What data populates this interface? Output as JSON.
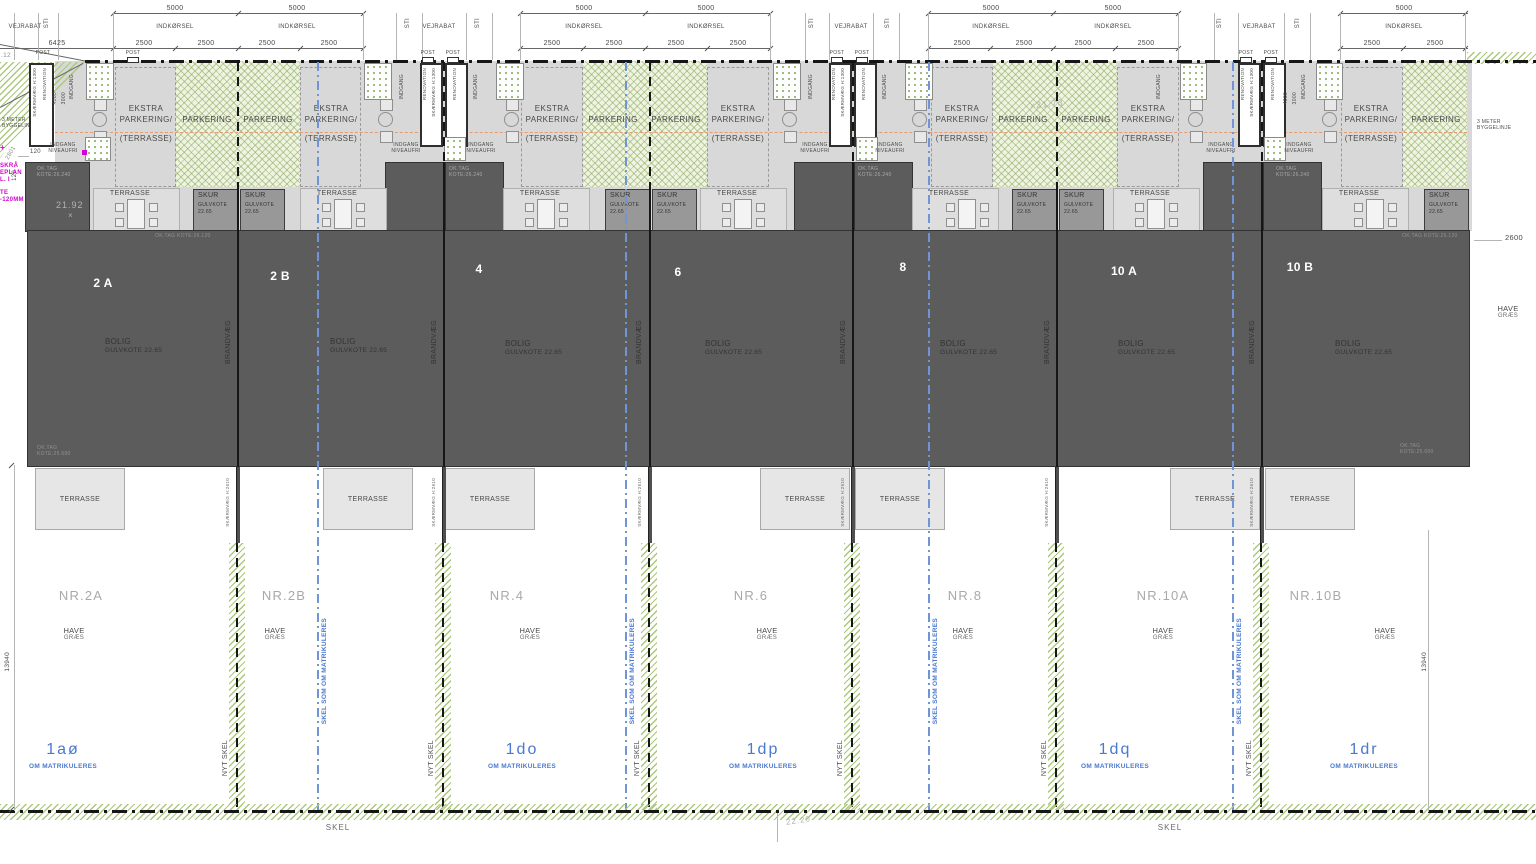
{
  "dims": {
    "d5000": "5000",
    "d2500": "2500",
    "d6425": "6425",
    "d4000": "4000",
    "d3000": "3000",
    "d120": "120",
    "d2600": "2600",
    "d13940": "13940",
    "d2801": "2801"
  },
  "road": {
    "vejrabat": "VEJRABAT",
    "sti": "STI",
    "indkorsel": "INDKØRSEL",
    "post": "POST",
    "corner_ref": ".12"
  },
  "entry": {
    "renovation": "RENOVATION",
    "skaermvaeg": "SKÆRMVÆG H:1300",
    "indgang": "INDGANG",
    "niveaufri1": "INDGANG",
    "niveaufri2": "NIVEAUFRI",
    "oktag": "OK.TAG",
    "kote26240": "KOTE:26.240"
  },
  "yard": {
    "ekstra1": "EKSTRA",
    "ekstra2": "PARKERING/",
    "ekstra3": "(TERRASSE)",
    "parkering": "PARKERING",
    "bygge1": "3 METER",
    "bygge2": "BYGGELINJE"
  },
  "building": {
    "units": [
      "2 A",
      "2 B",
      "4",
      "6",
      "8",
      "10 A",
      "10 B"
    ],
    "bolig": "BOLIG",
    "gulvkote": "GULVKOTE 22.65",
    "brandvaeg": "BRANDVÆG",
    "oktag": "OK.TAG",
    "kote26120": "KOTE:26.120",
    "kote25690": "KOTE:25.690"
  },
  "skur": {
    "l1": "SKUR",
    "l2": "GULVKOTE",
    "l3": "22.65"
  },
  "terrasse": {
    "label": "TERRASSE"
  },
  "rear": {
    "skaermvaeg2610": "SKÆRMVÆG H:2610"
  },
  "garden": {
    "nr": [
      "NR.2A",
      "NR.2B",
      "NR.4",
      "NR.6",
      "NR.8",
      "NR.10A",
      "NR.10B"
    ],
    "have": "HAVE",
    "graes": "GRÆS",
    "nytskel": "NYT SKEL",
    "skel": "SKEL",
    "skelsom": "SKEL SOM OM MATRIKULERES",
    "parcels": [
      "1aø",
      "1do",
      "1dp",
      "1dq",
      "1dr"
    ],
    "om": "OM MATRIKULERES"
  },
  "spots": {
    "s2192": "21.92",
    "s2173": "×21.73",
    "s2220": "22.20",
    "x": "×"
  },
  "notes": {
    "m1": "SKRÅ",
    "m2": "EPLAN",
    "m3": "L. I",
    "m4": "TE",
    "m5": "-120MM"
  }
}
